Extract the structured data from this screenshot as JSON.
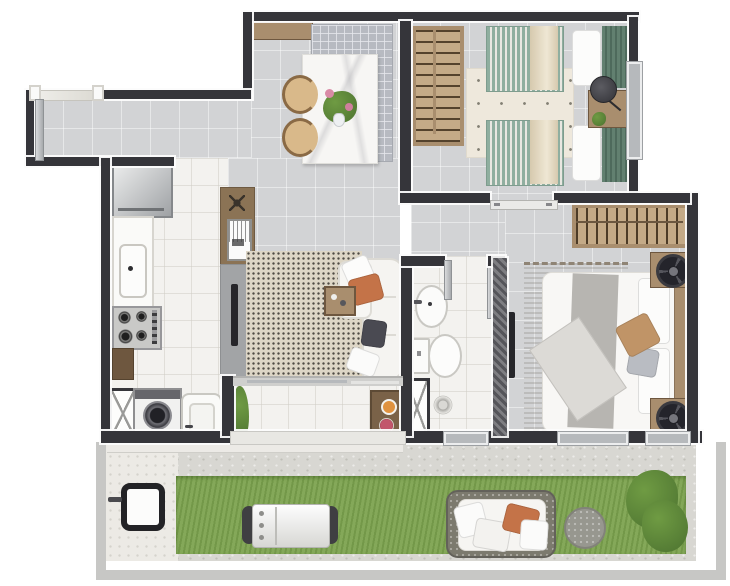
{
  "meta": {
    "kind": "apartment-floor-plan-render",
    "view": "top-down",
    "visible_text": []
  },
  "colors": {
    "wall": "#35353a",
    "steel": "#b6b9bc",
    "floorGray": "#d2d3d5",
    "floorWhite": "#f3f2ef",
    "grass": "#7da350",
    "concrete": "#d8d7d2",
    "pavement": "#eceae5",
    "fence": "#c7c7c5",
    "woodDark": "#6e573f",
    "woodMid": "#a98e6e",
    "woodLight": "#c4aa87",
    "marble": "#f7f6f4",
    "teal": "#8fae9f",
    "tealDark": "#628070",
    "drape": "#d6c9ae",
    "cream": "#eee8dc",
    "rugBeige": "#ddd6c6",
    "rugMaster": "#c3b7a7",
    "orange": "#c47348",
    "tan": "#c09467",
    "pillowGray": "#b9bcc2",
    "plantGreen": "#6f8f4f",
    "bushGreen": "#6f9b43",
    "white": "#fafaf9"
  },
  "rooms": [
    {
      "id": "entry-hall",
      "items": [
        "entry-door",
        "marble-threshold"
      ]
    },
    {
      "id": "kitchen",
      "items": [
        "refrigerator",
        "sink-counter",
        "cooktop",
        "lower-cabinet"
      ]
    },
    {
      "id": "laundry",
      "items": [
        "washing-machine",
        "laundry-tub",
        "service-shaft"
      ]
    },
    {
      "id": "living-dining-room",
      "items": [
        "sideboard-shelf",
        "grid-rug",
        "dining-table",
        "flower-centerpiece",
        "dining-chair",
        "dining-chair",
        "console",
        "framed-print",
        "tv-panel",
        "tv",
        "area-rug",
        "sofa",
        "orange-pillow",
        "dark-pillow",
        "white-pillow",
        "serving-tray"
      ]
    },
    {
      "id": "bedroom-2",
      "items": [
        "wardrobe",
        "twin-bed",
        "twin-bed",
        "cross-rug",
        "nightstand-desk",
        "stool",
        "potted-plant",
        "window",
        "door-leaf"
      ]
    },
    {
      "id": "hallway",
      "items": [
        "open-wardrobe-rack"
      ]
    },
    {
      "id": "bathroom",
      "items": [
        "pedestal-sink",
        "toilet",
        "shower-drain",
        "glass-partition",
        "door-leaf",
        "service-shaft"
      ]
    },
    {
      "id": "master-bedroom",
      "items": [
        "double-bed",
        "tan-pillow",
        "gray-throw",
        "folded-blanket",
        "striped-rug",
        "nightstand",
        "fan",
        "nightstand",
        "fan",
        "wall-tv",
        "window",
        "window"
      ]
    },
    {
      "id": "terrace",
      "items": [
        "sliding-glass-door",
        "potted-plant",
        "snack-table",
        "drink",
        "berry-plate"
      ]
    },
    {
      "id": "backyard",
      "items": [
        "perimeter-fence",
        "concrete-walkway",
        "paved-patio",
        "lawn",
        "side-gate",
        "barbecue-grill",
        "outdoor-sofa",
        "orange-outdoor-pillow",
        "outdoor-pouf",
        "garden-bush"
      ]
    }
  ]
}
